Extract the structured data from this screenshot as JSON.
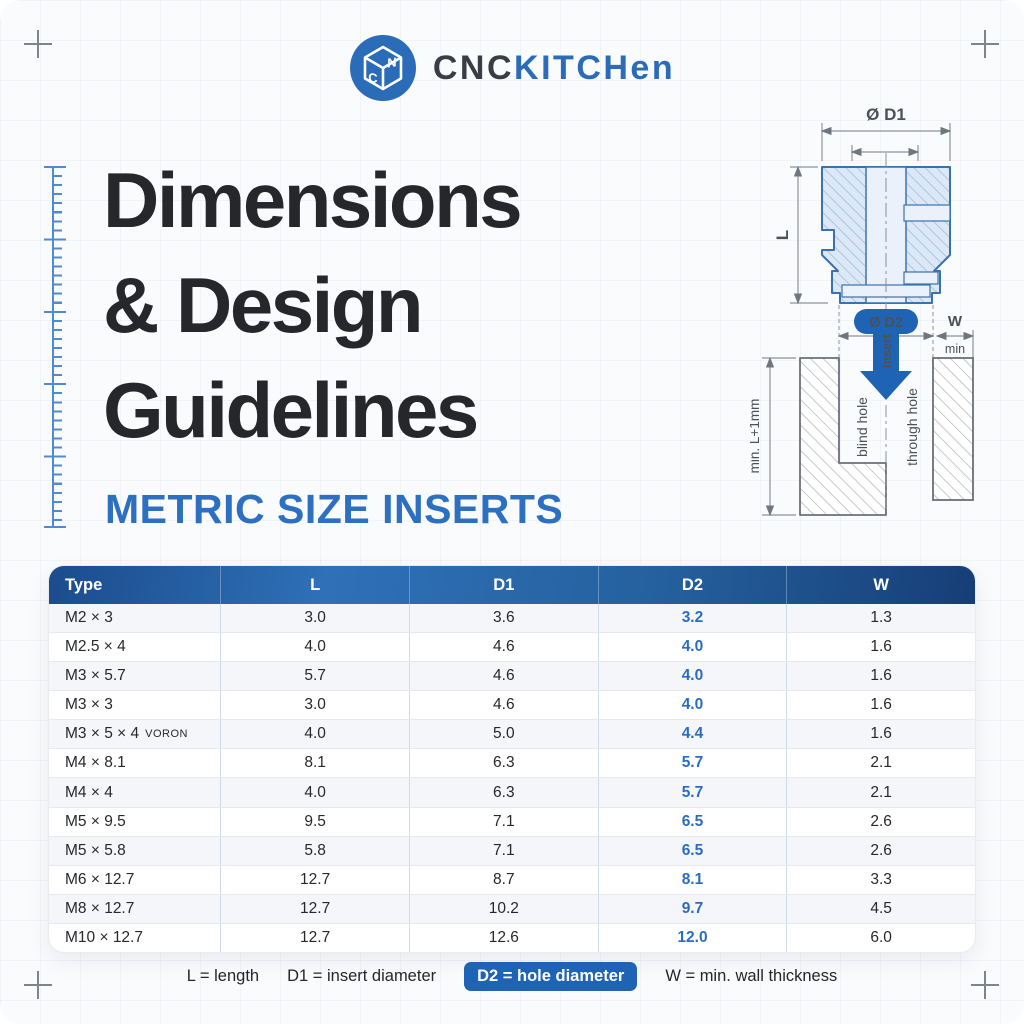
{
  "brand": {
    "cnc": "CNC",
    "kitchen": "KITCHen"
  },
  "title": {
    "line1": "Dimensions",
    "line2": "& Design",
    "line3": "Guidelines",
    "subtitle": "METRIC SIZE INSERTS"
  },
  "diagram": {
    "d1_label": "Ø D1",
    "l_label": "L",
    "d2_label": "Ø D2",
    "w_label": "W",
    "min_label": "min",
    "insert_label": "insert",
    "blind_hole_label": "blind hole",
    "through_hole_label": "through hole",
    "depth_label": "min. L+1mm"
  },
  "table": {
    "columns": [
      "Type",
      "L",
      "D1",
      "D2",
      "W"
    ],
    "rows": [
      {
        "type": "M2 × 3",
        "l": "3.0",
        "d1": "3.6",
        "d2": "3.2",
        "w": "1.3"
      },
      {
        "type": "M2.5 × 4",
        "l": "4.0",
        "d1": "4.6",
        "d2": "4.0",
        "w": "1.6"
      },
      {
        "type": "M3 × 5.7",
        "l": "5.7",
        "d1": "4.6",
        "d2": "4.0",
        "w": "1.6"
      },
      {
        "type": "M3 × 3",
        "l": "3.0",
        "d1": "4.6",
        "d2": "4.0",
        "w": "1.6"
      },
      {
        "type": "M3 × 5 × 4",
        "suffix": "VORON",
        "l": "4.0",
        "d1": "5.0",
        "d2": "4.4",
        "w": "1.6"
      },
      {
        "type": "M4 × 8.1",
        "l": "8.1",
        "d1": "6.3",
        "d2": "5.7",
        "w": "2.1"
      },
      {
        "type": "M4 × 4",
        "l": "4.0",
        "d1": "6.3",
        "d2": "5.7",
        "w": "2.1"
      },
      {
        "type": "M5 × 9.5",
        "l": "9.5",
        "d1": "7.1",
        "d2": "6.5",
        "w": "2.6"
      },
      {
        "type": "M5 × 5.8",
        "l": "5.8",
        "d1": "7.1",
        "d2": "6.5",
        "w": "2.6"
      },
      {
        "type": "M6 × 12.7",
        "l": "12.7",
        "d1": "8.7",
        "d2": "8.1",
        "w": "3.3"
      },
      {
        "type": "M8 × 12.7",
        "l": "12.7",
        "d1": "10.2",
        "d2": "9.7",
        "w": "4.5"
      },
      {
        "type": "M10 × 12.7",
        "l": "12.7",
        "d1": "12.6",
        "d2": "12.0",
        "w": "6.0"
      }
    ]
  },
  "legend": {
    "l": "L = length",
    "d1": "D1 = insert diameter",
    "d2": "D2 = hole diameter",
    "w": "W = min. wall thickness"
  },
  "colors": {
    "accent": "#2b6cb8",
    "header_gradient_dark": "#1b4c8d",
    "header_gradient_light": "#2f70b7",
    "d2_value_blue": "#2b6cc2",
    "pill_blue": "#1f63b5"
  }
}
